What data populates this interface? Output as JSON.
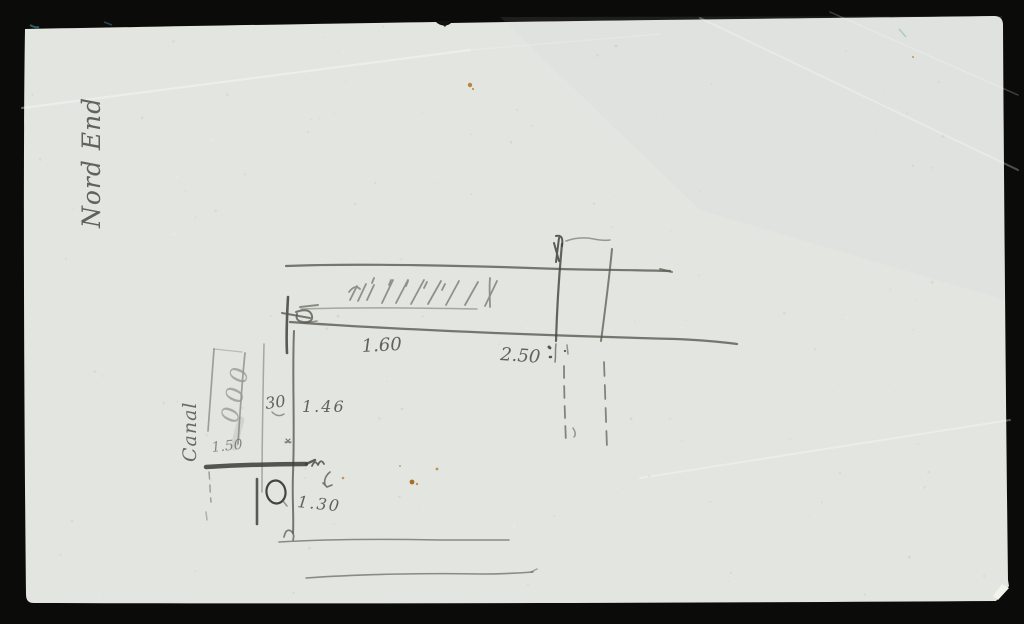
{
  "scene": {
    "description": "Pencil sketch with measurements on aged paper, photographed on a black background",
    "background_color": "#0b0b09",
    "paper_color": "#e3e5e0",
    "pencil_color": "#55554d",
    "foxing_color": "#b5721f"
  },
  "annotations": {
    "margin_note": "Nord End",
    "canal_note": "Canal",
    "zeros_column": "000",
    "dim_upper_left": "1.60",
    "dim_upper_right": "2.50",
    "width_note": "30",
    "dim_middle": "1.46",
    "column_dim": "1.50",
    "dim_lower": "1.30"
  }
}
